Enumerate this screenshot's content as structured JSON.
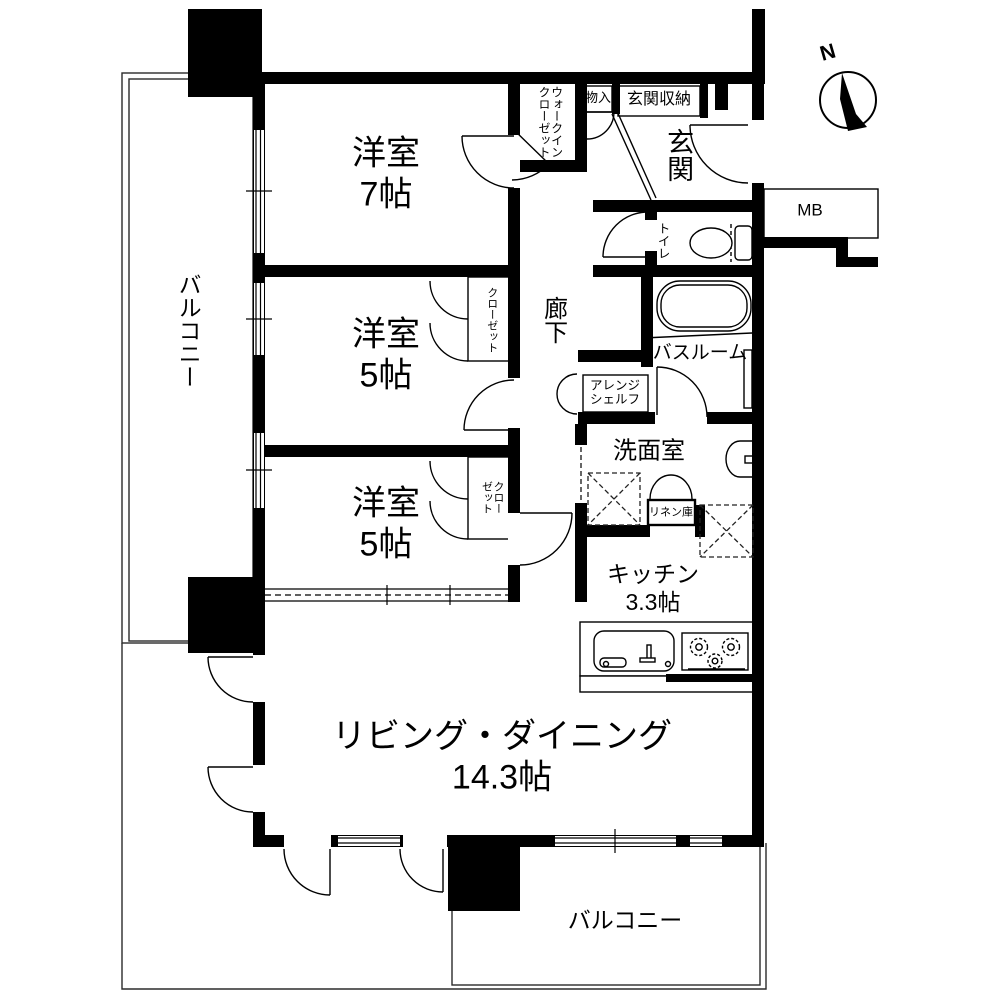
{
  "title": "間取り図",
  "compass": {
    "north_label": "N"
  },
  "colors": {
    "wall": "#000000",
    "thin_line": "#2b2b2b",
    "background": "#ffffff"
  },
  "rooms": {
    "bedroom1": {
      "name": "洋室",
      "size": "7帖"
    },
    "bedroom2": {
      "name": "洋室",
      "size": "5帖"
    },
    "bedroom3": {
      "name": "洋室",
      "size": "5帖"
    },
    "living": {
      "name": "リビング・ダイニング",
      "size": "14.3帖"
    },
    "kitchen": {
      "name": "キッチン",
      "size": "3.3帖"
    },
    "entrance": {
      "name": "玄関"
    },
    "hallway": {
      "name": "廊下"
    },
    "toilet": {
      "name": "トイレ"
    },
    "bathroom": {
      "name": "バスルーム"
    },
    "washroom": {
      "name": "洗面室"
    },
    "balcony_left": {
      "name": "バルコニー"
    },
    "balcony_bottom": {
      "name": "バルコニー"
    }
  },
  "storage": {
    "walk_in_closet": {
      "name": "ウォークインクローゼット"
    },
    "storage_small": {
      "name": "物入"
    },
    "entrance_storage": {
      "name": "玄関収納"
    },
    "closet_bedroom2": {
      "name": "クローゼット"
    },
    "closet_bedroom3": {
      "name": "クローゼット"
    },
    "arrange_shelf": {
      "name": "アレンジシェルフ"
    },
    "linen": {
      "name": "リネン庫"
    },
    "meter_box": {
      "name": "MB"
    }
  }
}
